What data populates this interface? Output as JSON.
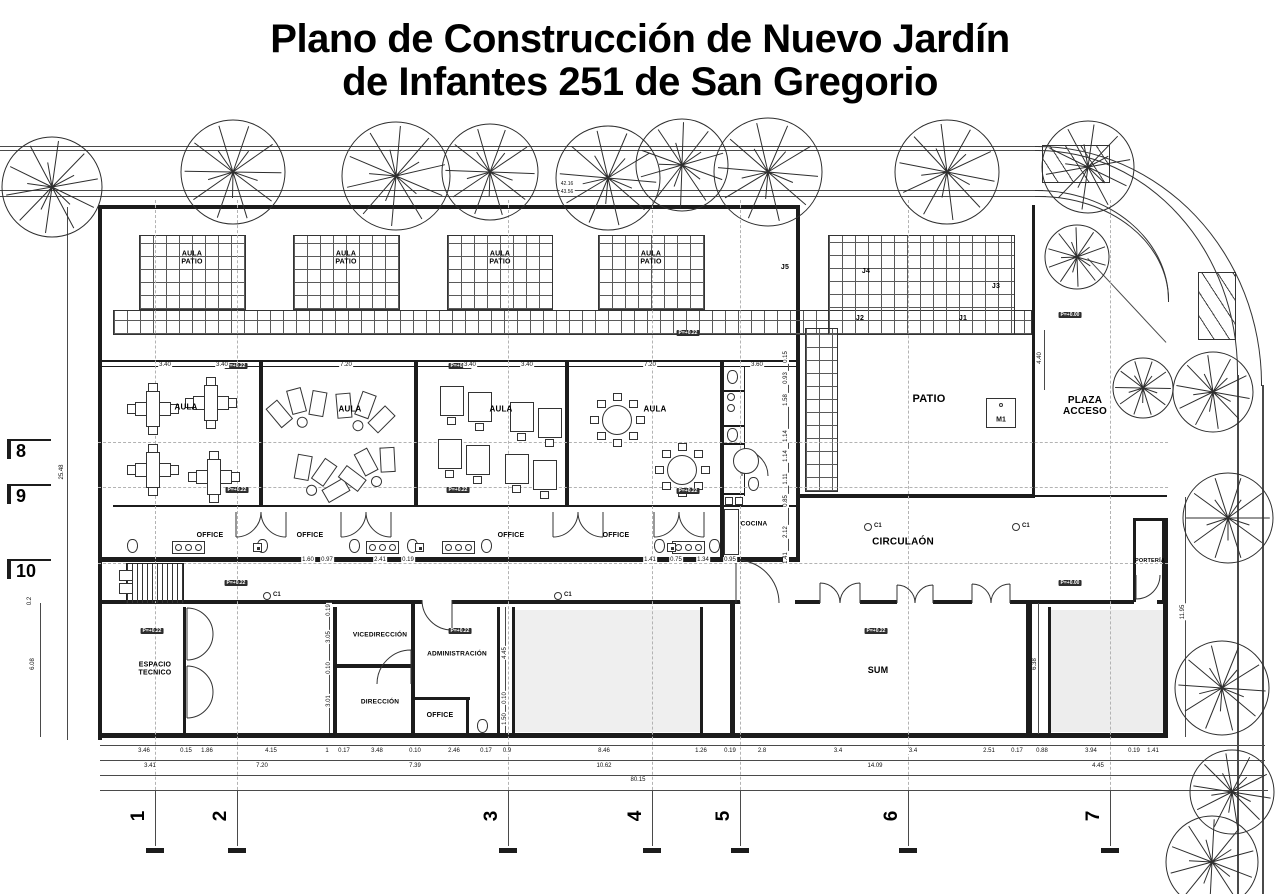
{
  "title": {
    "line1": "Plano de Construcción de Nuevo Jardín",
    "line2": "de Infantes 251 de San Gregorio"
  },
  "rooms": [
    {
      "name": "aula-patio-1",
      "text": "AULA\nPATIO",
      "x": 192,
      "y": 258,
      "fs": 7
    },
    {
      "name": "aula-patio-2",
      "text": "AULA\nPATIO",
      "x": 346,
      "y": 258,
      "fs": 7
    },
    {
      "name": "aula-patio-3",
      "text": "AULA\nPATIO",
      "x": 500,
      "y": 258,
      "fs": 7
    },
    {
      "name": "aula-patio-4",
      "text": "AULA\nPATIO",
      "x": 651,
      "y": 258,
      "fs": 7
    },
    {
      "name": "aula-1",
      "text": "AULA",
      "x": 186,
      "y": 408,
      "fs": 8
    },
    {
      "name": "aula-2",
      "text": "AULA",
      "x": 350,
      "y": 410,
      "fs": 8
    },
    {
      "name": "aula-3",
      "text": "AULA",
      "x": 501,
      "y": 410,
      "fs": 8
    },
    {
      "name": "aula-4",
      "text": "AULA",
      "x": 655,
      "y": 410,
      "fs": 8
    },
    {
      "name": "office-1",
      "text": "OFFICE",
      "x": 210,
      "y": 536,
      "fs": 7
    },
    {
      "name": "office-2",
      "text": "OFFICE",
      "x": 310,
      "y": 536,
      "fs": 7
    },
    {
      "name": "office-3",
      "text": "OFFICE",
      "x": 511,
      "y": 536,
      "fs": 7
    },
    {
      "name": "office-4",
      "text": "OFFICE",
      "x": 616,
      "y": 536,
      "fs": 7
    },
    {
      "name": "cocina",
      "text": "COCINA",
      "x": 754,
      "y": 524,
      "fs": 6.5
    },
    {
      "name": "patio",
      "text": "PATIO",
      "x": 929,
      "y": 399,
      "fs": 11
    },
    {
      "name": "plaza-acceso",
      "text": "PLAZA\nACCESO",
      "x": 1085,
      "y": 406,
      "fs": 10
    },
    {
      "name": "circulacion",
      "text": "CIRCULAÓN",
      "x": 903,
      "y": 542,
      "fs": 10
    },
    {
      "name": "espacio-tecnico",
      "text": "ESPACIO\nTECNICO",
      "x": 155,
      "y": 669,
      "fs": 7
    },
    {
      "name": "vicedireccion",
      "text": "VICEDIRECCIÓN",
      "x": 380,
      "y": 635,
      "fs": 6.5
    },
    {
      "name": "direccion",
      "text": "DIRECCIÓN",
      "x": 380,
      "y": 702,
      "fs": 6.5
    },
    {
      "name": "administracion",
      "text": "ADMINISTRACIÓN",
      "x": 457,
      "y": 654,
      "fs": 6.5
    },
    {
      "name": "office-admin",
      "text": "OFFICE",
      "x": 440,
      "y": 716,
      "fs": 7
    },
    {
      "name": "sum",
      "text": "SUM",
      "x": 878,
      "y": 671,
      "fs": 9
    },
    {
      "name": "porteria",
      "text": "PORTERÍA",
      "x": 1150,
      "y": 561,
      "fs": 5.5
    }
  ],
  "joint_labels": [
    {
      "text": "J5",
      "x": 785,
      "y": 268
    },
    {
      "text": "J4",
      "x": 866,
      "y": 272
    },
    {
      "text": "J3",
      "x": 996,
      "y": 287
    },
    {
      "text": "J2",
      "x": 860,
      "y": 319
    },
    {
      "text": "J1",
      "x": 963,
      "y": 319
    }
  ],
  "markers": {
    "c1_label": "C1",
    "c1_positions": [
      {
        "x": 267,
        "y": 596
      },
      {
        "x": 558,
        "y": 596
      },
      {
        "x": 868,
        "y": 527
      },
      {
        "x": 1016,
        "y": 527
      }
    ],
    "m1": {
      "text": "M1",
      "x": 986,
      "y": 398
    }
  },
  "elevations": [
    {
      "x": 236,
      "y": 366,
      "t": "P=+0.22"
    },
    {
      "x": 460,
      "y": 366,
      "t": "P=+0.22"
    },
    {
      "x": 688,
      "y": 333,
      "t": "P=+0.22"
    },
    {
      "x": 1070,
      "y": 315,
      "t": "P=+0.00"
    },
    {
      "x": 237,
      "y": 490,
      "t": "P=+0.22"
    },
    {
      "x": 458,
      "y": 490,
      "t": "P=+0.22"
    },
    {
      "x": 688,
      "y": 491,
      "t": "P=+0.22"
    },
    {
      "x": 152,
      "y": 631,
      "t": "P=+0.22"
    },
    {
      "x": 236,
      "y": 583,
      "t": "P=+0.22"
    },
    {
      "x": 460,
      "y": 631,
      "t": "P=+0.22"
    },
    {
      "x": 876,
      "y": 631,
      "t": "P=+0.22"
    },
    {
      "x": 1070,
      "y": 583,
      "t": "P=+0.00"
    }
  ],
  "axes": {
    "bottom": [
      {
        "n": "1",
        "x": 155
      },
      {
        "n": "2",
        "x": 237
      },
      {
        "n": "3",
        "x": 508
      },
      {
        "n": "4",
        "x": 652
      },
      {
        "n": "5",
        "x": 740
      },
      {
        "n": "6",
        "x": 908
      },
      {
        "n": "7",
        "x": 1110
      }
    ],
    "left": [
      {
        "n": "8",
        "y": 447
      },
      {
        "n": "9",
        "y": 492
      },
      {
        "n": "10",
        "y": 567
      }
    ]
  },
  "dimensions": {
    "top_row": {
      "y": 365,
      "items": [
        [
          165,
          "3.40"
        ],
        [
          222,
          "3.40"
        ],
        [
          346,
          "7.20"
        ],
        [
          470,
          "3.40"
        ],
        [
          527,
          "3.40"
        ],
        [
          650,
          "7.20"
        ],
        [
          757,
          "3.60"
        ]
      ]
    },
    "sanitary_row": {
      "y": 560,
      "items": [
        [
          308,
          "1.60"
        ],
        [
          327,
          "0.97"
        ],
        [
          380,
          "2.41"
        ],
        [
          408,
          "0.19"
        ],
        [
          650,
          "1.41"
        ],
        [
          676,
          "0.75"
        ],
        [
          703,
          "1.34"
        ],
        [
          730,
          "0.95"
        ]
      ]
    },
    "bottom_row_1": {
      "y": 751,
      "items": [
        [
          144,
          "3.46"
        ],
        [
          186,
          "0.15"
        ],
        [
          207,
          "1.86"
        ],
        [
          271,
          "4.15"
        ],
        [
          327,
          "1"
        ],
        [
          344,
          "0.17"
        ],
        [
          377,
          "3.48"
        ],
        [
          415,
          "0.10"
        ],
        [
          454,
          "2.46"
        ],
        [
          486,
          "0.17"
        ],
        [
          507,
          "0.9"
        ],
        [
          604,
          "8.46"
        ],
        [
          701,
          "1.26"
        ],
        [
          730,
          "0.19"
        ],
        [
          762,
          "2.8"
        ],
        [
          838,
          "3.4"
        ],
        [
          913,
          "3.4"
        ],
        [
          989,
          "2.51"
        ],
        [
          1017,
          "0.17"
        ],
        [
          1042,
          "0.88"
        ],
        [
          1091,
          "3.94"
        ],
        [
          1134,
          "0.19"
        ],
        [
          1153,
          "1.41"
        ]
      ]
    },
    "bottom_row_2": {
      "y": 766,
      "items": [
        [
          150,
          "3.41"
        ],
        [
          262,
          "7.20"
        ],
        [
          415,
          "7.39"
        ],
        [
          604,
          "10.62"
        ],
        [
          875,
          "14.09"
        ],
        [
          1098,
          "4.45"
        ]
      ]
    },
    "bottom_row_3": {
      "y": 780,
      "items": [
        [
          638,
          "80.15"
        ]
      ]
    },
    "vertical": [
      [
        62,
        472,
        "25.48"
      ],
      [
        33,
        664,
        "6.08"
      ],
      [
        30,
        601,
        "0.2"
      ],
      [
        1183,
        612,
        "11.95"
      ],
      [
        1035,
        664,
        "6.38"
      ],
      [
        1040,
        358,
        "4.40"
      ],
      [
        329,
        610,
        "0.19"
      ],
      [
        329,
        637,
        "3.05"
      ],
      [
        329,
        668,
        "0.10"
      ],
      [
        329,
        701,
        "3.01"
      ],
      [
        505,
        653,
        "4.45"
      ],
      [
        505,
        698,
        "0.10"
      ],
      [
        505,
        719,
        "1.50"
      ],
      [
        786,
        357,
        "0.15"
      ],
      [
        786,
        378,
        "0.93"
      ],
      [
        786,
        400,
        "1.58"
      ],
      [
        786,
        436,
        "1.14"
      ],
      [
        786,
        456,
        "1.14"
      ],
      [
        786,
        479,
        "1.11"
      ],
      [
        786,
        501,
        "0.85"
      ],
      [
        786,
        532,
        "2.12"
      ],
      [
        786,
        558,
        "1.41"
      ]
    ],
    "micro_top": [
      [
        567,
        184,
        "42.16"
      ],
      [
        567,
        192,
        "43.56"
      ]
    ]
  }
}
